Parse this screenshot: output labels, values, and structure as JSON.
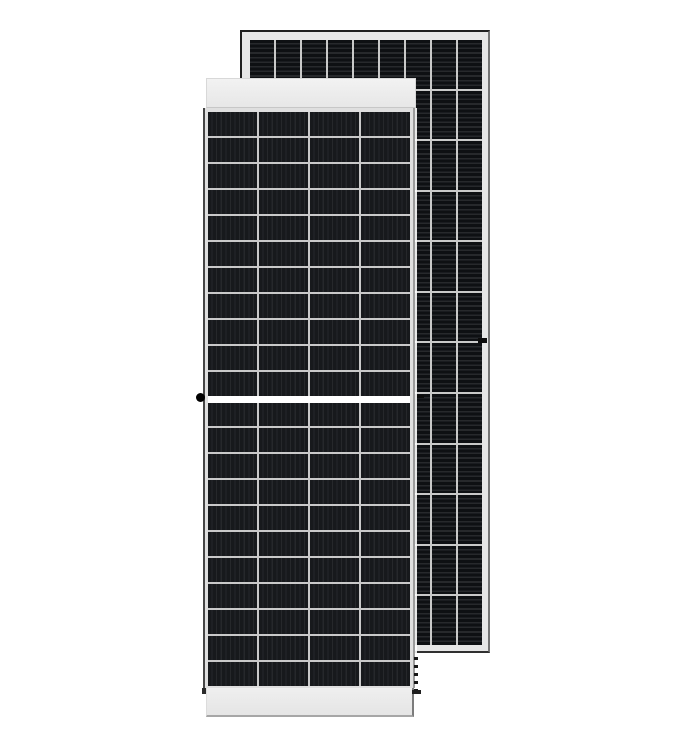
{
  "meta": {
    "title": "Solar panel module product image",
    "description": "Product photo of two framed monocrystalline half-cut-cell solar PV modules on a plain white background. The front module is shown face-on with a white top and bottom frame strip; a second module, seen from its other face with cells rotated 90 degrees, stands behind and to the right."
  },
  "colors": {
    "background": "#ffffff",
    "frame_light": "#e6e6e6",
    "frame_dark_edge": "#1e1e1e",
    "grid_line": "#c9c9c9",
    "back_cell_dark": "#0e1013",
    "back_cell_light": "#27292c",
    "front_cell_dark": "#17191c",
    "front_cell_light": "#26282b",
    "center_gap": "#ffffff",
    "mount_dot": "#000000"
  },
  "front_panel": {
    "label": "front solar module, front face",
    "cell_columns": 4,
    "cell_rows_per_half": 11,
    "halves": 2,
    "total_cells": 88,
    "busbar_stripe_direction": "vertical",
    "features": [
      "white top frame strip",
      "white bottom frame strip",
      "central white half-cut gap between upper and lower cell halves",
      "black round mounting dot on left frame edge"
    ]
  },
  "back_panel": {
    "label": "rear solar module, partially hidden behind front module",
    "visible_cell_columns": 9,
    "cell_rows": 12,
    "busbar_stripe_direction": "horizontal",
    "features": [
      "light gray aluminium frame with dark outer edge",
      "small black frame clip on right frame edge",
      "small black clip mark near centre-right",
      "dashed shadow line below front module right edge"
    ]
  }
}
